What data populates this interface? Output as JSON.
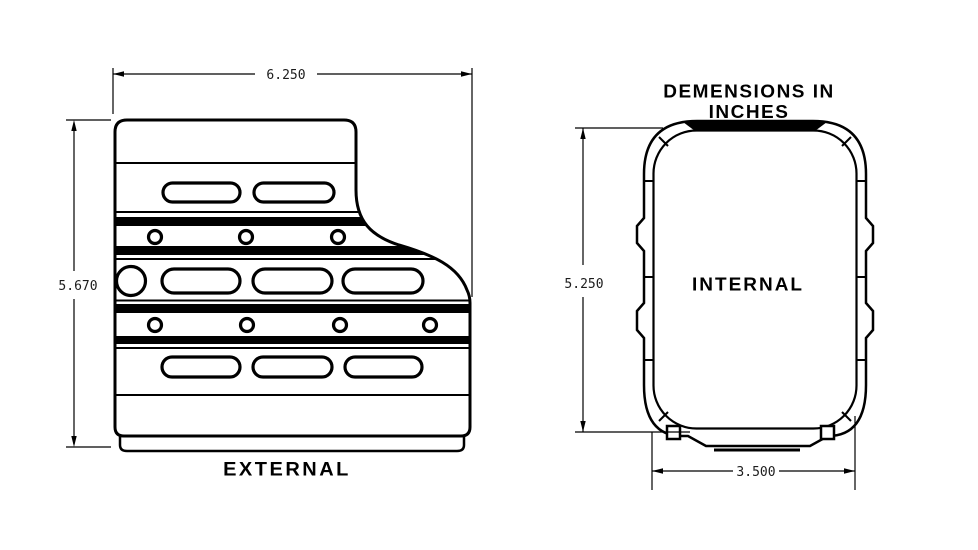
{
  "title": "DEMENSIONS IN INCHES",
  "external_view": {
    "label": "EXTERNAL",
    "dimensions": {
      "width_in": "6.250",
      "height_in": "5.670"
    }
  },
  "internal_view": {
    "label": "INTERNAL",
    "dimensions": {
      "height_in": "5.250",
      "width_in": "3.500"
    }
  },
  "colors": {
    "line": "#000000",
    "background": "#ffffff"
  }
}
